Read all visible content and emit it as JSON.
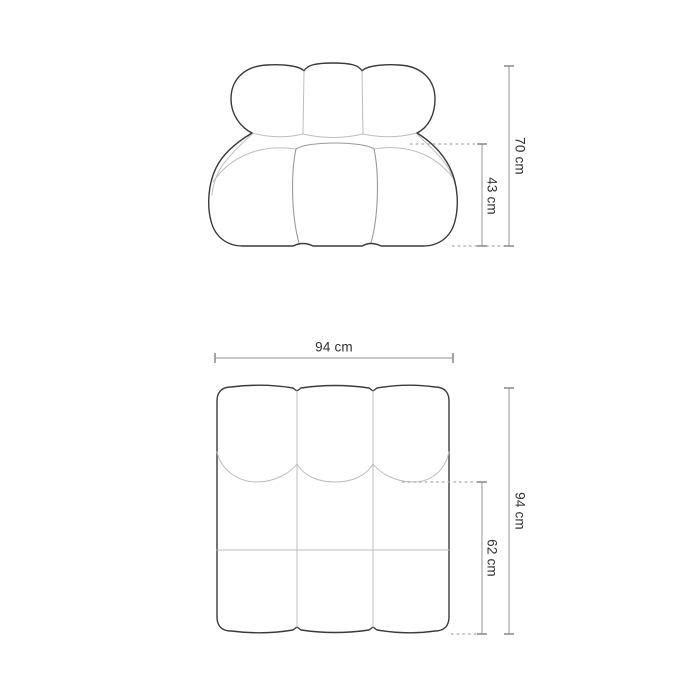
{
  "colors": {
    "background": "#ffffff",
    "figure_outline": "#3a3a3a",
    "seam_line": "#bdbdbd",
    "cushion_line": "#9a9a9a",
    "dimension_line": "#a8a8a8",
    "label_text": "#303030"
  },
  "front_view": {
    "total_height": "70 cm",
    "seat_height": "43 cm"
  },
  "top_view": {
    "width": "94 cm",
    "total_depth": "94 cm",
    "seat_depth": "62 cm"
  }
}
